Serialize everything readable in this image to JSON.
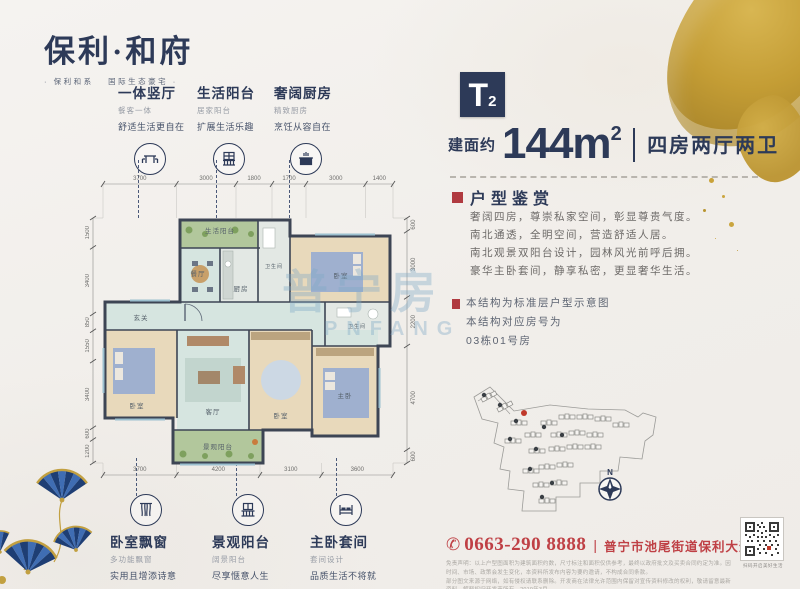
{
  "logo": {
    "title": "保利·和府",
    "subtitle": "· 保利和系　 国际生态豪宅 ·"
  },
  "unit": {
    "type_letter": "T",
    "type_sub": "2",
    "area_prefix": "建面约",
    "area_value": "144m",
    "area_sup": "2",
    "layout": "四房两厅两卫"
  },
  "appreciation": {
    "title": "户型鉴赏",
    "lines": [
      "奢阔四房，尊崇私家空间，彰显尊贵气度。",
      "南北通透，全明空间，营造舒适人居。",
      "南北观景双阳台设计，园林风光前呼后拥。",
      "豪华主卧套间，静享私密，更显奢华生活。"
    ]
  },
  "note": {
    "line1": "本结构为标准层户型示意图",
    "line2": "本结构对应房号为",
    "line3": "03栋01号房"
  },
  "callouts_top": [
    {
      "title": "一体竖厅",
      "sub1": "餐客一体",
      "sub2": "舒适生活更自在",
      "icon": "dining-table-icon"
    },
    {
      "title": "生活阳台",
      "sub1": "居家阳台",
      "sub2": "扩展生活乐趣",
      "icon": "life-balcony-icon"
    },
    {
      "title": "奢阔厨房",
      "sub1": "精致厨房",
      "sub2": "烹饪从容自在",
      "icon": "kitchen-icon"
    }
  ],
  "callouts_bottom": [
    {
      "title": "卧室飘窗",
      "sub1": "多功能飘窗",
      "sub2": "实用且增添诗意",
      "icon": "bay-window-icon"
    },
    {
      "title": "景观阳台",
      "sub1": "阔景阳台",
      "sub2": "尽享惬意人生",
      "icon": "view-balcony-icon"
    },
    {
      "title": "主卧套间",
      "sub1": "套间设计",
      "sub2": "品质生活不将就",
      "icon": "bed-icon"
    }
  ],
  "floorplan": {
    "dims_top": [
      "3700",
      "3000",
      "1800",
      "1700",
      "3000",
      "1400"
    ],
    "dims_bottom": [
      "3700",
      "4200",
      "3100",
      "3600"
    ],
    "dims_left": [
      "1500",
      "3400",
      "850",
      "1550",
      "3400",
      "600",
      "1200"
    ],
    "dims_right": [
      "600",
      "3000",
      "2200",
      "4700",
      "600"
    ],
    "rooms": {
      "balcony_top": "生活阳台",
      "dining": "餐厅",
      "kitchen": "厨房",
      "bath_top": "卫生间",
      "bed_top_right": "卧室",
      "bath_right": "卫生间",
      "hall": "玄关",
      "bed_left": "卧室",
      "living": "客厅",
      "bed_mid": "卧室",
      "master": "主卧",
      "balcony_bottom": "景观阳台"
    }
  },
  "siteplan": {
    "north_label": "N"
  },
  "contact": {
    "phone_icon": "✆",
    "phone": "0663-290 8888",
    "divider": "|",
    "address": "普宁市池尾街道保利大道1号"
  },
  "qr": {
    "caption": "扫码开启美好生活"
  },
  "disclaimer": {
    "line1": "免责声明：以上户型图面积为建筑面积约数，尺寸标注和面积仅供参考，最终以政府批文及买卖合同约定为准。因时间、市场、政策会发生变化，本资料所发布内容为要约邀请，不构成合同条款。",
    "line2": "部分图文来源于网络，如有侵权请联系删除。开发商在法律允许范围内保留对宣传资料修改的权利，敬请留意最新资料，解释权归开发商所有。2019年3月"
  },
  "watermark": {
    "cn": "普宁房",
    "en": "PNFANG"
  },
  "colors": {
    "navy": "#2d3a58",
    "red": "#bf4045",
    "gold": "#c2a041"
  }
}
